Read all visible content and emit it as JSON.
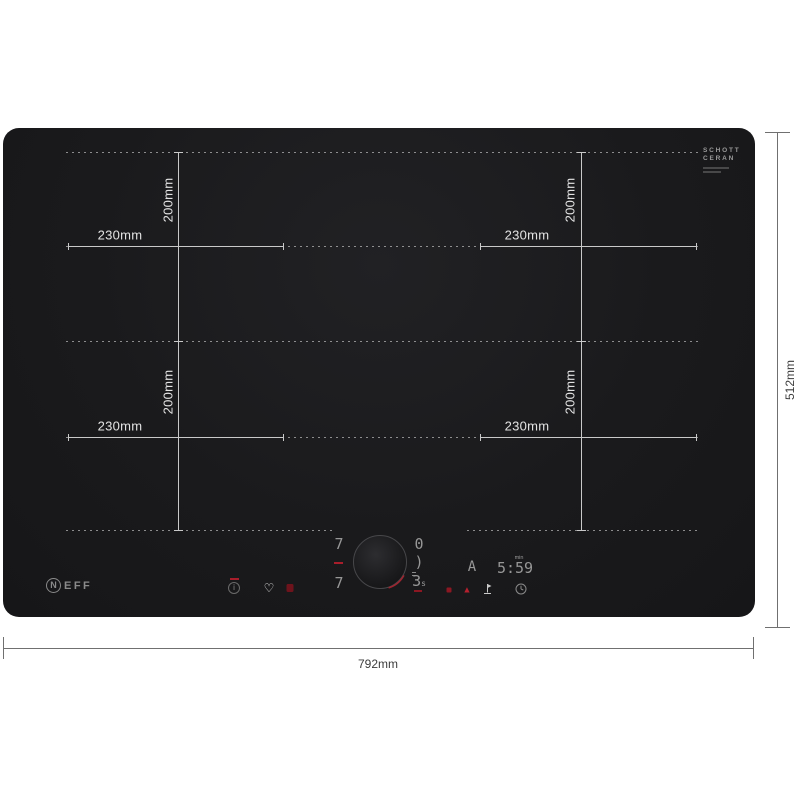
{
  "colors": {
    "page_bg": "#ffffff",
    "hob_surface": "#1a1a1c",
    "glass_marking": "#c9c9c9",
    "glass_label": "#e3e3e3",
    "dimension_line": "#707070",
    "dimension_text": "#3c3c3c",
    "display_segment": "#979797",
    "accent_red": "#a81e2b"
  },
  "branding": {
    "neff_initial": "N",
    "neff_rest": "EFF",
    "glass_line1": "SCHOTT",
    "glass_line2": "CERAN"
  },
  "dimension_labels": {
    "zone_width": "230mm",
    "zone_depth": "200mm",
    "overall_width": "792mm",
    "overall_depth": "512mm"
  },
  "display": {
    "left_zone_top": "7",
    "left_zone_bottom": "7",
    "right_zone_top": "0",
    "right_zone_mid": ")",
    "right_zone_bottom": "3",
    "right_zone_bottom_unit": "s",
    "timer_mode": "A",
    "timer_value": "5:59",
    "timer_unit": "min",
    "info_glyph": "i",
    "heart_glyph": "♡",
    "triangle_glyph": "▲"
  }
}
